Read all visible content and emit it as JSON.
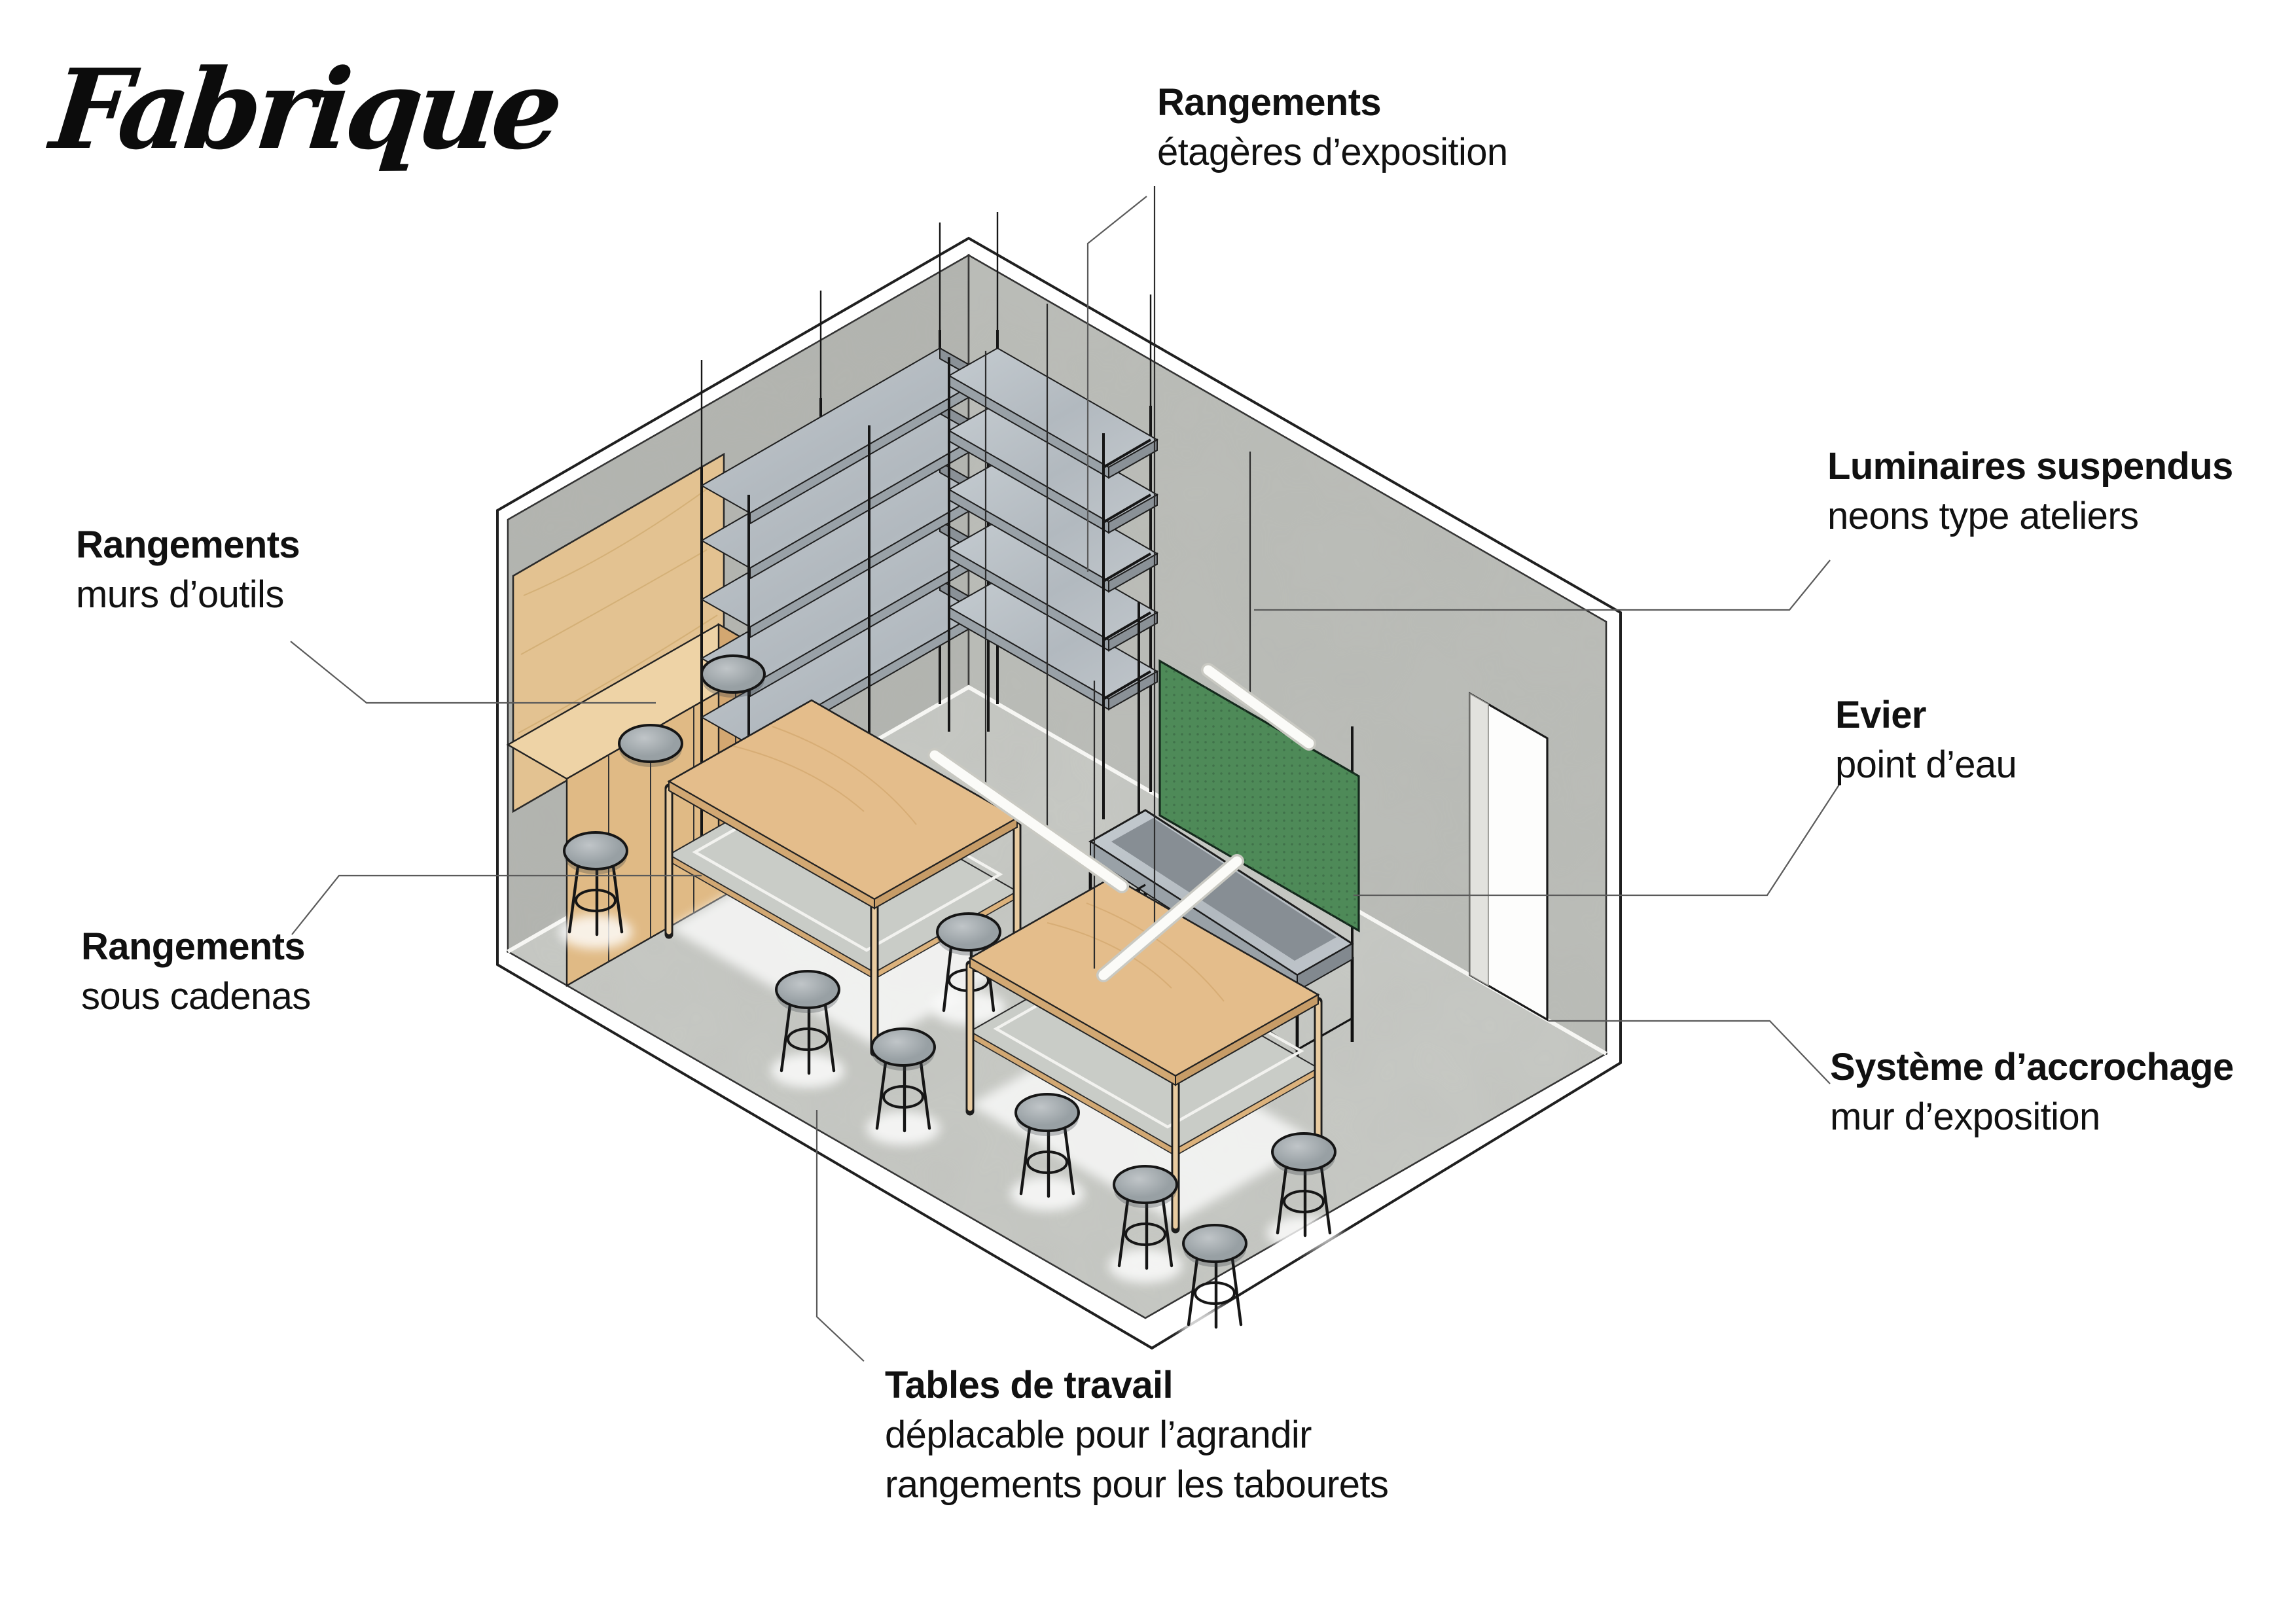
{
  "logo": {
    "text": "Fabrique"
  },
  "labels": {
    "etageres": {
      "title": "Rangements",
      "lines": [
        "étagères d’exposition"
      ]
    },
    "luminaires": {
      "title": "Luminaires suspendus",
      "lines": [
        "neons type ateliers"
      ]
    },
    "evier": {
      "title": "Evier",
      "lines": [
        "point d’eau"
      ]
    },
    "accrochage": {
      "title": "Système d’accrochage",
      "lines": [
        "mur d’exposition"
      ]
    },
    "outils": {
      "title": "Rangements",
      "lines": [
        "murs d’outils"
      ]
    },
    "cadenas": {
      "title": "Rangements",
      "lines": [
        "sous cadenas"
      ]
    },
    "tables": {
      "title": "Tables de travail",
      "lines": [
        "déplacable pour l’agrandir",
        "rangements pour les tabourets"
      ]
    }
  },
  "colors": {
    "wall": "#b3b5b0",
    "wall2": "#bbbdb8",
    "floor": "#c7c9c4",
    "plywood": "#e3c291",
    "wood": "#e4bd8b",
    "woodtop": "#eed3a6",
    "green": "#4e8a58",
    "metal": "#bcc3c8",
    "metaldark": "#99a1a7",
    "frame": "#1c1c1c",
    "leader": "#5a5a5a"
  }
}
